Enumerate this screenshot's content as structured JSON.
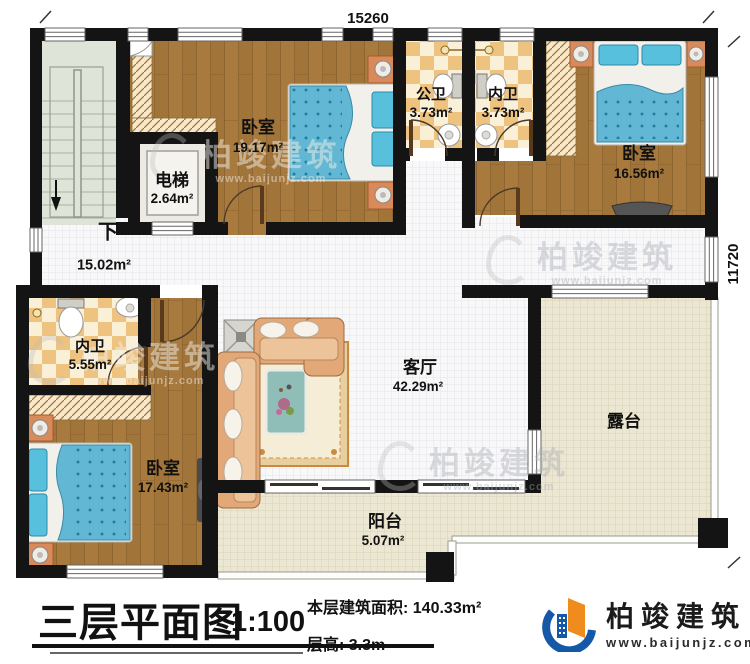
{
  "plan": {
    "dim_top": "15260",
    "dim_right": "11720",
    "labels": {
      "stairs_down": "下",
      "hallway_area": "15.02m²",
      "elevator_name": "电梯",
      "elevator_area": "2.64m²",
      "bedroom_top_left_name": "卧室",
      "bedroom_top_left_area": "19.17m²",
      "public_bath_name": "公卫",
      "public_bath_area": "3.73m²",
      "ensuite_top_name": "内卫",
      "ensuite_top_area": "3.73m²",
      "bedroom_top_right_name": "卧室",
      "bedroom_top_right_area": "16.56m²",
      "ensuite_bottom_name": "内卫",
      "ensuite_bottom_area": "5.55m²",
      "bedroom_bottom_left_name": "卧室",
      "bedroom_bottom_left_area": "17.43m²",
      "living_room_name": "客厅",
      "living_room_area": "42.29m²",
      "terrace_name": "露台",
      "balcony_name": "阳台",
      "balcony_area": "5.07m²"
    }
  },
  "footer": {
    "title": "三层平面图",
    "scale": "1:100",
    "area_line": "本层建筑面积: 140.33m²",
    "height_line": "层高: 3.3m"
  },
  "brand": {
    "name": "柏竣建筑",
    "website": "www.baijunjz.com"
  },
  "watermark": {
    "name": "柏竣建筑",
    "website": "www.baijunjz.com"
  },
  "colors": {
    "wall": "#141414",
    "wood": "#a87a3e",
    "checker_dark": "#eec27f",
    "checker_light": "#faf0d8",
    "stairs": "#dfe4d8",
    "grid_floor": "#f8f8f9",
    "terrace": "#ece7d2",
    "bed_blue": "#62b8d4",
    "sofa_peach": "#e2a878",
    "brand_blue": "#1458a8",
    "brand_orange": "#f08c1e"
  }
}
